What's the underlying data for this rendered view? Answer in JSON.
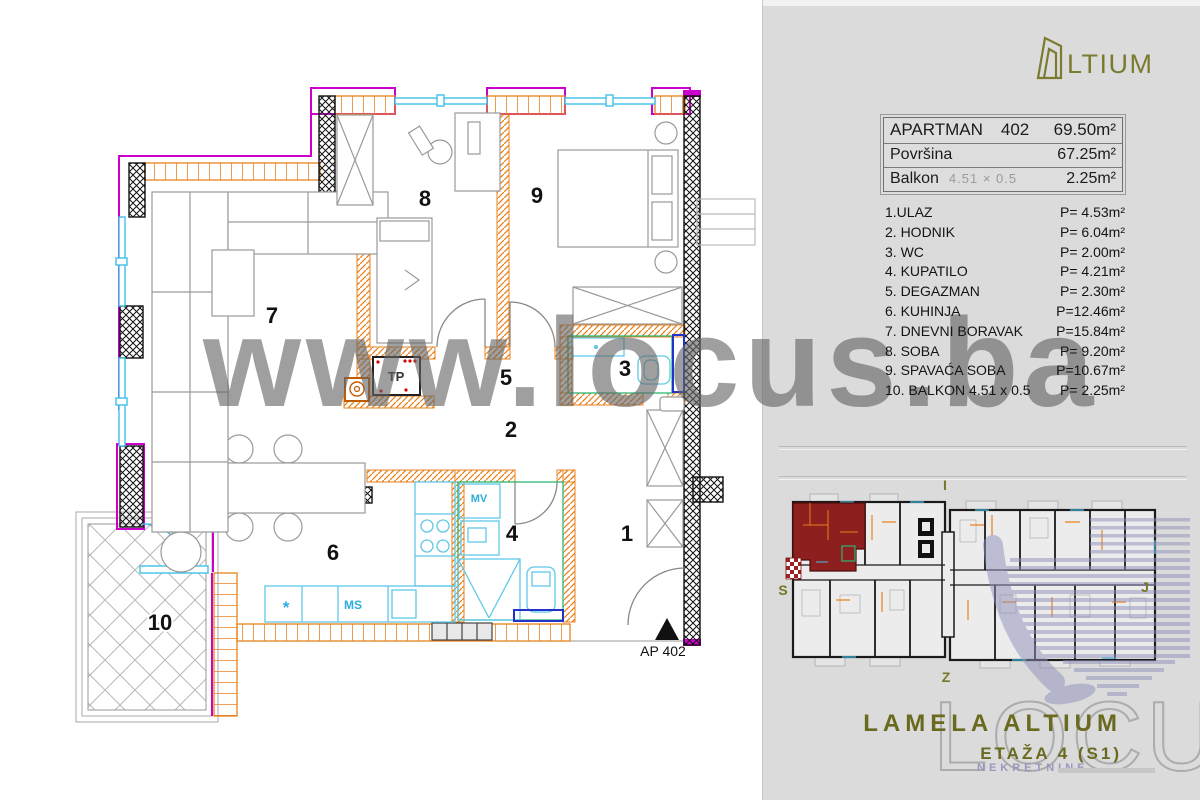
{
  "watermark": {
    "text": "www.locus.ba"
  },
  "panel": {
    "brand": {
      "glyph": "altium-door-icon",
      "wordmark": "LTIUM",
      "color": "#7B7B30"
    },
    "info_table": {
      "row1": {
        "label": "APARTMAN",
        "number": "402",
        "value": "69.50m²"
      },
      "row2": {
        "label": "Površina",
        "value": "67.25m²"
      },
      "row3": {
        "label": "Balkon",
        "dims": "4.51 × 0.5",
        "value": "2.25m²"
      }
    },
    "rooms": [
      {
        "label": "1.ULAZ",
        "area": "P= 4.53m²"
      },
      {
        "label": "2. HODNIK",
        "area": "P= 6.04m²"
      },
      {
        "label": "3. WC",
        "area": "P= 2.00m²"
      },
      {
        "label": "4. KUPATILO",
        "area": "P= 4.21m²"
      },
      {
        "label": "5. DEGAZMAN",
        "area": "P= 2.30m²"
      },
      {
        "label": "6. KUHINJA",
        "area": "P=12.46m²"
      },
      {
        "label": "7. DNEVNI BORAVAK",
        "area": "P=15.84m²"
      },
      {
        "label": "8. SOBA",
        "area": "P= 9.20m²"
      },
      {
        "label": "9. SPAVAĆA SOBA",
        "area": "P=10.67m²"
      },
      {
        "label": "10. BALKON 4.51 x 0.5",
        "area": "P= 2.25m²"
      }
    ],
    "compass": {
      "top": "I",
      "left": "S",
      "bottom": "Z",
      "right": "J"
    },
    "footer": {
      "lamela": "LAMELA ALTIUM",
      "etaza": "ETAŽA 4 (S1)",
      "locus": "LOCUS",
      "nekretnine": "NEKRETNINE"
    }
  },
  "plan": {
    "room_numbers": [
      "1",
      "2",
      "3",
      "4",
      "5",
      "6",
      "7",
      "8",
      "9",
      "10"
    ],
    "labels": {
      "tp": "TP",
      "mv": "MV",
      "ms": "MS",
      "star": "*",
      "ap": "AP 402"
    },
    "colors": {
      "wall_orange": "#E8821E",
      "window_cyan": "#3FC0E8",
      "accent_magenta": "#CC00CC",
      "bath_green": "#2BB673",
      "door_blue": "#2233CC",
      "unit_red": "#8E1F1F",
      "brand_olive": "#6F6F26",
      "locus_purple": "#8E8EBB"
    }
  }
}
